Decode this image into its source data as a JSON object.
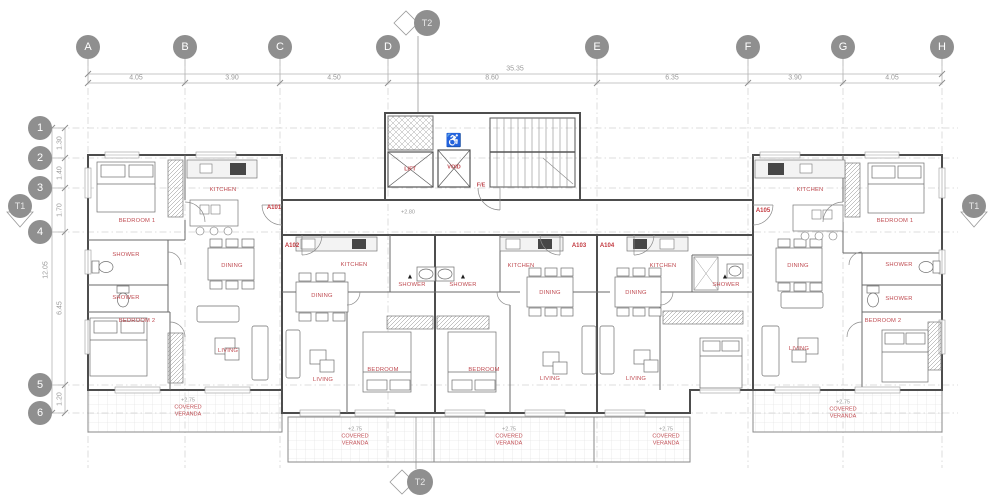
{
  "grid": {
    "columns": [
      "A",
      "B",
      "C",
      "D",
      "E",
      "F",
      "G",
      "H"
    ],
    "rows": [
      "1",
      "2",
      "3",
      "4",
      "5",
      "6"
    ],
    "column_dims": [
      "4.05",
      "3.90",
      "4.50",
      "8.60",
      "6.35",
      "3.90",
      "4.05"
    ],
    "row_dims": [
      "1.30",
      "1.40",
      "1.70",
      "6.45",
      "1.20"
    ],
    "total_width": "35.35",
    "total_height": "12.05"
  },
  "markers": {
    "t1": "T1",
    "t2": "T2"
  },
  "apartments": [
    "A101",
    "A102",
    "A103",
    "A104",
    "A105"
  ],
  "core": {
    "lift": "LIFT",
    "void": "VOID",
    "fire_escape": "F/E",
    "level": "+2.80"
  },
  "room_labels": [
    "KITCHEN",
    "BEDROOM 1",
    "SHOWER",
    "DINING",
    "SHOWER",
    "BEDROOM 2",
    "LIVING",
    "KITCHEN",
    "DINING",
    "SHOWER",
    "BEDROOM",
    "LIVING",
    "SHOWER",
    "KITCHEN",
    "DINING",
    "BEDROOM",
    "LIVING",
    "KITCHEN",
    "DINING",
    "SHOWER",
    "LIVING",
    "KITCHEN",
    "BEDROOM 1",
    "DINING",
    "SHOWER",
    "SHOWER",
    "BEDROOM 2",
    "LIVING"
  ],
  "veranda": {
    "name": "COVERED VERANDA",
    "level": "+2.75"
  },
  "icons": {
    "wheelchair": "♿",
    "warning": "▲"
  },
  "colors": {
    "label_red": "#bf4a50",
    "grid_gray": "#8f8f8f",
    "wall": "#4d4d4d"
  }
}
